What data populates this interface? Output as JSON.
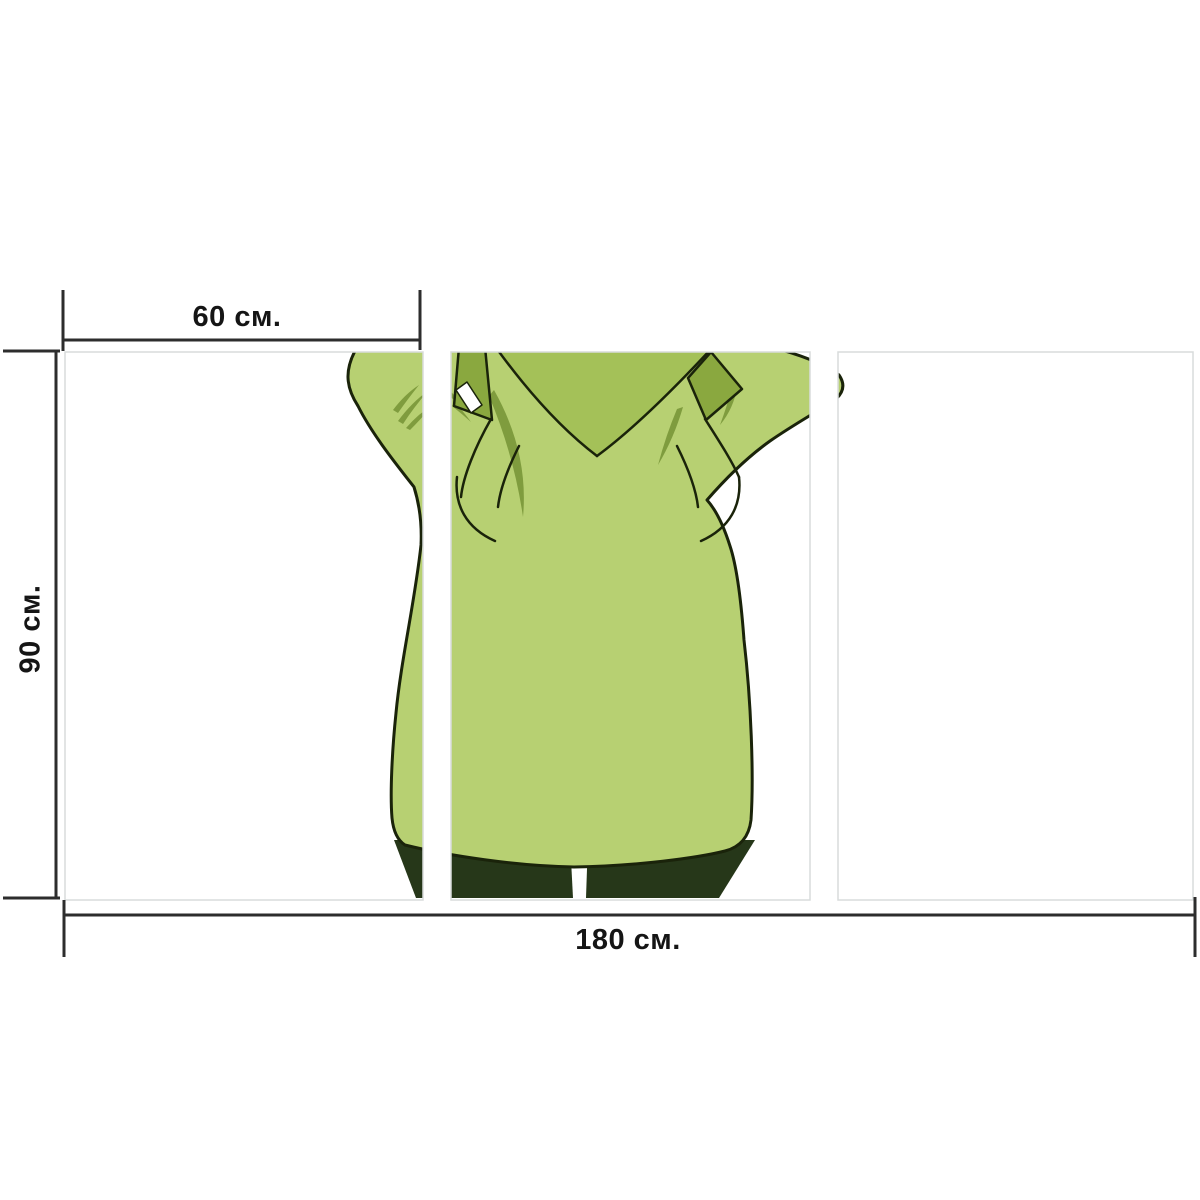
{
  "product_diagram": {
    "type": "triptych-canvas-size-mockup",
    "dimensions": {
      "panel_width_label": "60 см.",
      "height_label": "90 см.",
      "total_width_label": "180 см."
    },
    "panels": [
      {
        "name": "left"
      },
      {
        "name": "center"
      },
      {
        "name": "right"
      }
    ],
    "artwork": {
      "name": "green-coat-figure-back-view"
    },
    "colors": {
      "coat": "#b7d072",
      "collar": "#a4c158",
      "straps": "#8aa83f",
      "wrinkles": "#7f9c3e",
      "pants": "#263719",
      "outline": "#1a230a",
      "highlight": "#ffffff",
      "panel_border": "#d8dcdc",
      "dimension_line": "#2d2d2d",
      "panel_background": "#ffffff"
    }
  }
}
